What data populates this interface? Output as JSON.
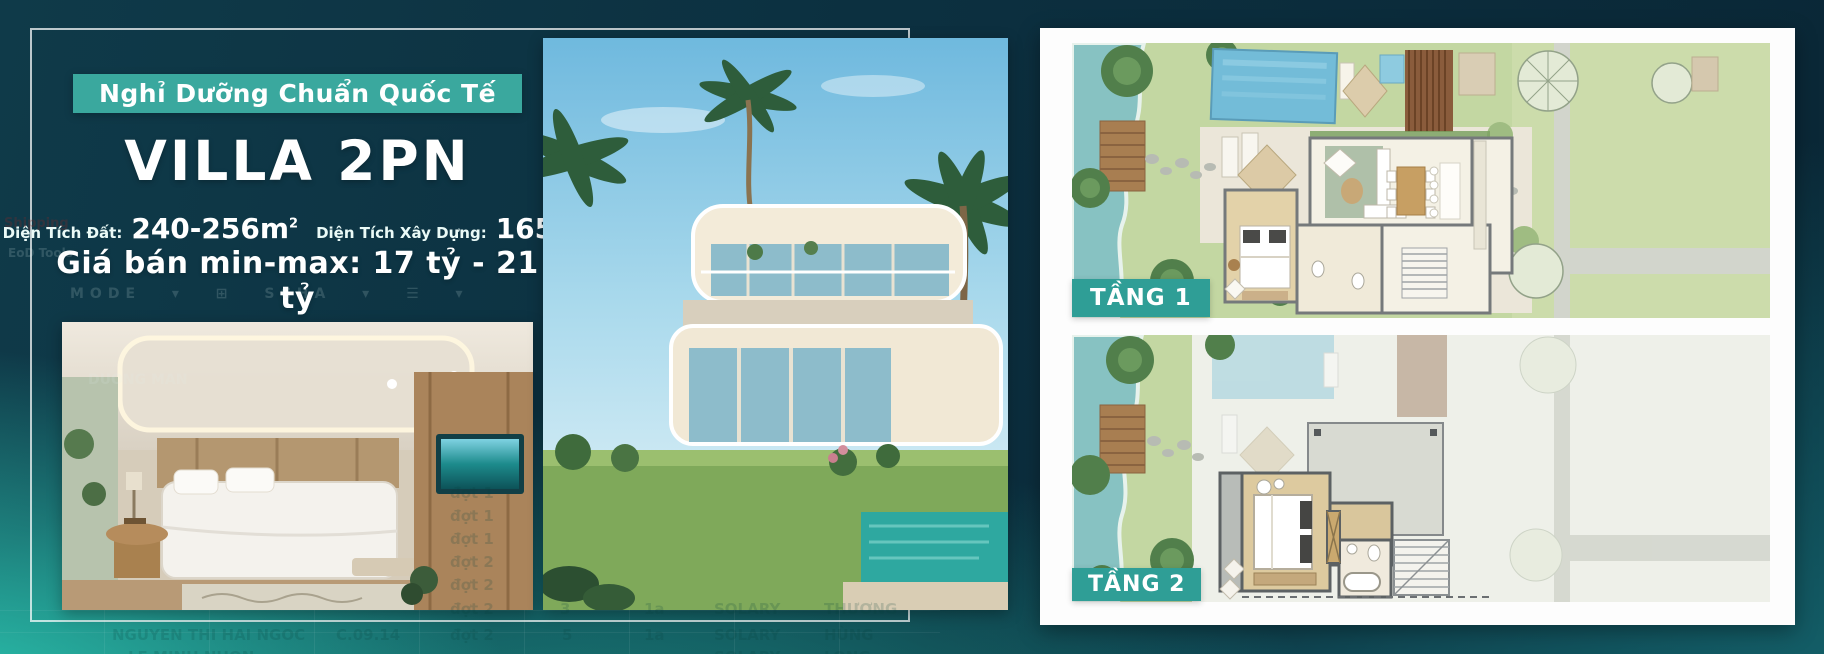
{
  "panel": {
    "badge": "Nghỉ Dưỡng Chuẩn Quốc Tế",
    "title": "VILLA 2PN",
    "stats": {
      "land_label": "Diện Tích Đất:",
      "land_value": "240-256m",
      "land_sup": "2",
      "build_label": "Diện Tích Xây Dựng:",
      "build_value": "165m",
      "build_sup": "2"
    },
    "price": "Giá bán min-max: 17 tỷ - 21 tỷ"
  },
  "floorplan": {
    "floor1_label": "TẦNG 1",
    "floor2_label": "TẦNG 2"
  },
  "colors": {
    "badge_teal": "#3AA89E",
    "label_teal": "#2F9E96",
    "bright_teal": "#2ED0B8",
    "navy": "#0C2D3D",
    "card_white": "#FDFDFD"
  },
  "ghost": {
    "menu_item_1": "Shipping",
    "menu_item_2": "EoD  Tools",
    "toolbar": "MODE ▾ ⊞ SCHA ▾ ☰ ▾",
    "photo_name": "DUONG MAN",
    "dots": [
      "đợt 1",
      "đợt 1",
      "đợt 1",
      "đợt 2",
      "đợt 2",
      "đợt 2",
      "đợt 2"
    ],
    "row_a": {
      "n1": "3",
      "n2": "1a",
      "salary": "SOLARY",
      "who": "THƯƠNG"
    },
    "row_b": {
      "name": "NGUYEN THI HAI NGOC",
      "code": "C.09.14",
      "n1": "5",
      "n2": "1a",
      "salary": "SOLARY",
      "who": "HÙNG"
    },
    "row_c": {
      "name": "LE MINH NHON",
      "salary": "SOLARY",
      "who": "LONG"
    }
  }
}
